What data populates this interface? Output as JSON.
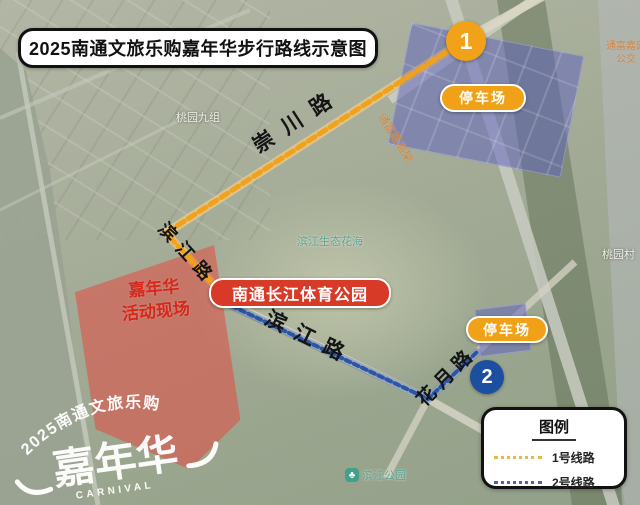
{
  "title": "2025南通文旅乐购嘉年华步行路线示意图",
  "points": {
    "p1": "1",
    "p2": "2"
  },
  "badges": {
    "parking1": "停车场",
    "parking2": "停车场",
    "park": "南通长江体育公园"
  },
  "carnival": {
    "line1": "嘉年华",
    "line2": "活动现场"
  },
  "roads": {
    "chongchuan": "崇川路",
    "binjiang_upper": "滨江路",
    "binjiang_lower": "滨江路",
    "huayue": "花月路",
    "viaduct": "通富路高架"
  },
  "labels": {
    "taoyuan_jiuzu": "桃园九组",
    "taoyuan_cun": "桃园村",
    "huahai": "滨江生态花海",
    "poi_park": "滨江公园",
    "bus_line1": "通富嘉园",
    "bus_line2": "公交"
  },
  "legend": {
    "title": "图例",
    "items": [
      {
        "label": "1号线路",
        "color": "#e6b93f"
      },
      {
        "label": "2号线路",
        "color": "#4668b0"
      }
    ]
  },
  "logo": {
    "arc": "2025南通文旅乐购",
    "main": "嘉年华",
    "sub": "CARNIVAL"
  },
  "routes": {
    "route1": {
      "color": "#f2a21a",
      "width": 5,
      "dash": "8 5",
      "points": "468,38 166,233 228,300"
    },
    "route2": {
      "color": "#2b55a7",
      "width": 4,
      "dash": "5 4",
      "points": "232,306 428,399 477,352"
    }
  },
  "colors": {
    "parking_badge": "#f0a117",
    "park_badge": "#d83a28",
    "point1": "#f2a219",
    "point2": "#1c4f9f",
    "carnival_fill": "rgba(227,74,66,0.55)",
    "parking_fill": "rgba(92,96,192,0.5)"
  }
}
